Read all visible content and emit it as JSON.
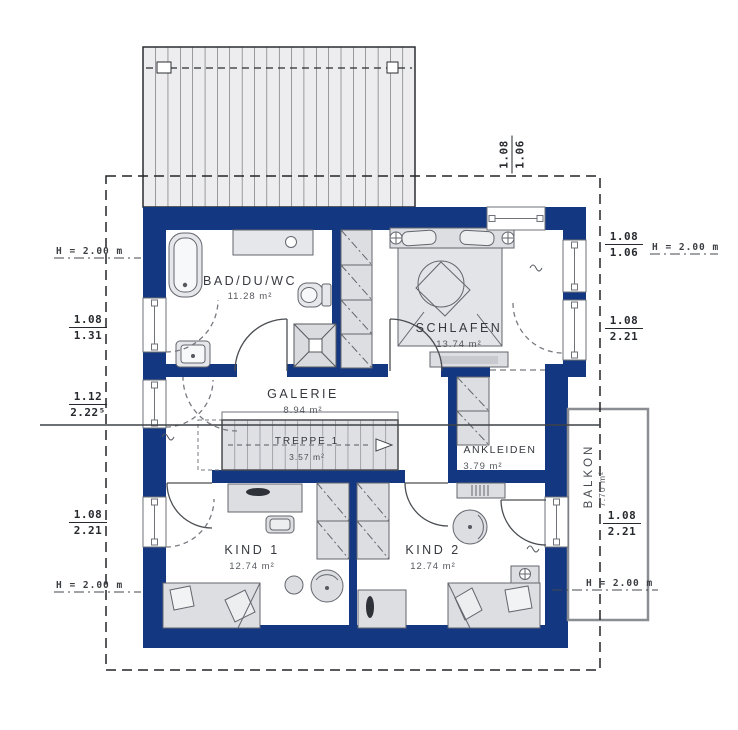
{
  "colors": {
    "wall": "#133781",
    "furniture_fill": "#dcdee2",
    "roof_fill": "#ededef"
  },
  "rooms": {
    "bad": {
      "name": "BAD/DU/WC",
      "area": "11.28 m²"
    },
    "schlafen": {
      "name": "SCHLAFEN",
      "area": "13.74 m²"
    },
    "galerie": {
      "name": "GALERIE",
      "area": "8.94 m²"
    },
    "treppe": {
      "name": "TREPPE 1",
      "area": "3.57 m²"
    },
    "ankleiden": {
      "name": "ANKLEIDEN",
      "area": "3.79 m²"
    },
    "kind1": {
      "name": "KIND 1",
      "area": "12.74 m²"
    },
    "kind2": {
      "name": "KIND 2",
      "area": "12.74 m²"
    },
    "balkon": {
      "name": "BALKON",
      "area": "7.70 m²"
    }
  },
  "dimensions": {
    "rotated_top_right": {
      "top": "1.08",
      "bottom": "1.06"
    },
    "left": {
      "height_top": "H = 2.00 m",
      "window_bad": {
        "top": "1.08",
        "bottom": "1.31"
      },
      "window_galerie": {
        "top": "1.12",
        "bottom": "2.22⁵"
      },
      "window_kind1": {
        "top": "1.08",
        "bottom": "2.21"
      },
      "height_bottom": "H = 2.00 m"
    },
    "right": {
      "window_schlafen": {
        "top": "1.08",
        "bottom": "1.06"
      },
      "height_top": "H = 2.00 m",
      "window_schlafen2": {
        "top": "1.08",
        "bottom": "2.21"
      },
      "door_balkon": {
        "top": "1.08",
        "bottom": "2.21"
      },
      "height_bottom": "H = 2.00 m"
    }
  }
}
